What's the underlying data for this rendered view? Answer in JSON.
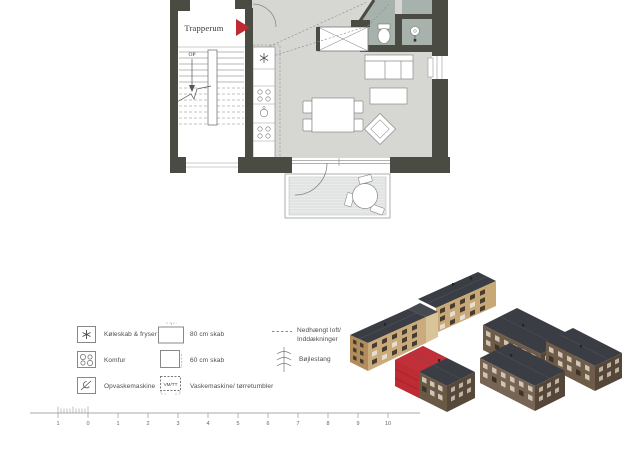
{
  "plan": {
    "stairwell_label": "Trapperum",
    "stairs_up_label": "OP"
  },
  "legend": {
    "items": [
      {
        "symbol": "fridge-symbol",
        "label": "Køleskab & fryser"
      },
      {
        "symbol": "stove-symbol",
        "label": "Komfur"
      },
      {
        "symbol": "dishwasher-symbol",
        "label": "Opvaskemaskine"
      },
      {
        "symbol": "cabinet-80-symbol",
        "label": "80 cm skab"
      },
      {
        "symbol": "cabinet-60-symbol",
        "label": "60 cm skab"
      },
      {
        "symbol": "washer-dryer-symbol",
        "symbol_text": "VM/TT",
        "label": "Vaskemaskine/ tørretumbler"
      },
      {
        "symbol": "suspended-ceiling-symbol",
        "label_line1": "Nedhængt loft/",
        "label_line2": "Inddækninger"
      },
      {
        "symbol": "clothes-rail-symbol",
        "label": "Bøjlestang"
      }
    ]
  },
  "scale_bar": {
    "labels": [
      "1",
      "0",
      "1",
      "2",
      "3",
      "4",
      "5",
      "6",
      "7",
      "8",
      "9",
      "10"
    ]
  },
  "colors": {
    "wall": "#4a4b43",
    "floor": "#d6d6d2",
    "bathroom_floor": "#a8b2ac",
    "balcony_floor": "#e9ebea",
    "highlight_red": "#bf2b33",
    "building_tan": "#c9a877",
    "building_brown": "#6e5c49",
    "roof_dark": "#3a3d44"
  }
}
